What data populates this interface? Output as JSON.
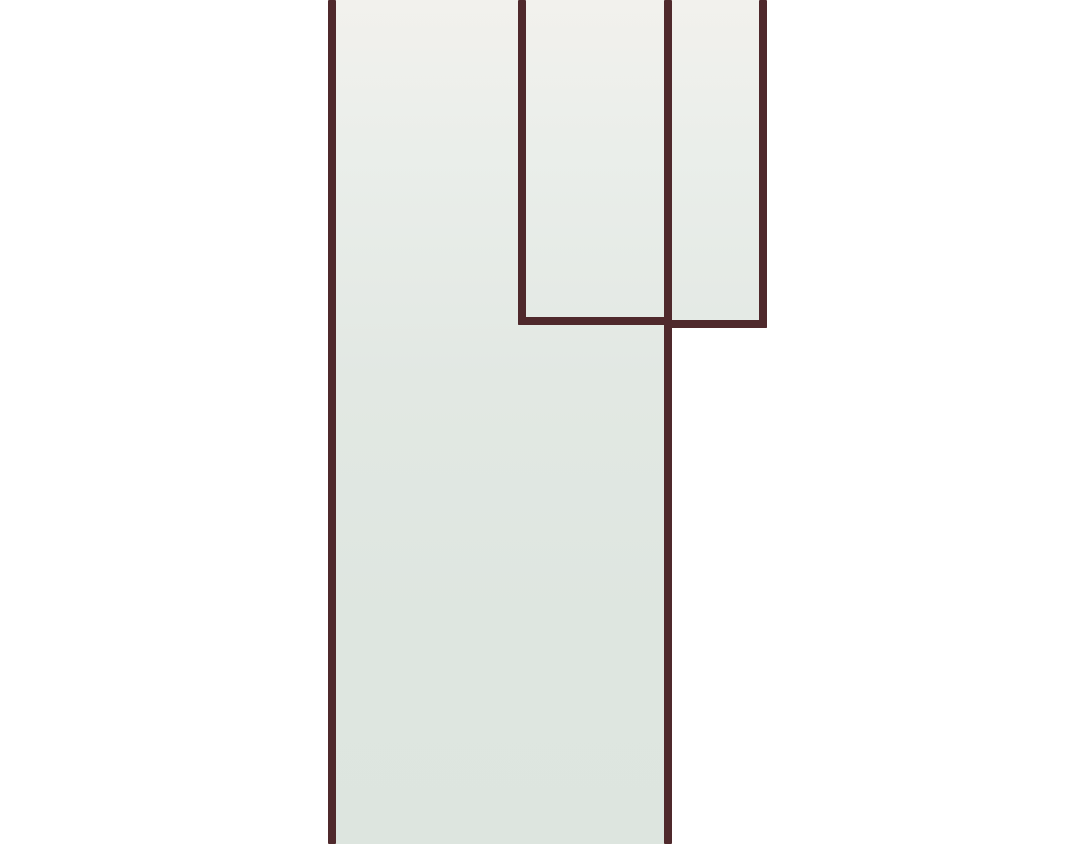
{
  "canvas": {
    "width": 1080,
    "height": 844,
    "background_color": "#ffffff"
  },
  "style": {
    "border_color": "#4f292c",
    "border_thickness": 8,
    "fill_gradient_height": 844,
    "fill_gradient_stops": [
      {
        "pos": 0,
        "color": "#f2f1ed"
      },
      {
        "pos": 18,
        "color": "#eaeeea"
      },
      {
        "pos": 45,
        "color": "#e2e8e3"
      },
      {
        "pos": 75,
        "color": "#dee6e0"
      },
      {
        "pos": 100,
        "color": "#dde5df"
      }
    ]
  },
  "shapes": {
    "fills": [
      {
        "name": "main-panel-fill",
        "x": 332,
        "y": 0,
        "w": 336,
        "h": 844
      },
      {
        "name": "top-right-panel-fill",
        "x": 668,
        "y": 0,
        "w": 95,
        "h": 324
      }
    ],
    "lines": [
      {
        "name": "main-panel-left-border",
        "x": 328,
        "y": 0,
        "w": 8,
        "h": 844
      },
      {
        "name": "inner-panel-left-border",
        "x": 518,
        "y": 0,
        "w": 8,
        "h": 325
      },
      {
        "name": "main-panel-right-border",
        "x": 664,
        "y": 0,
        "w": 8,
        "h": 844
      },
      {
        "name": "top-right-panel-right-border",
        "x": 759,
        "y": 0,
        "w": 8,
        "h": 328
      },
      {
        "name": "inner-panel-bottom-border",
        "x": 518,
        "y": 317,
        "w": 154,
        "h": 8
      },
      {
        "name": "top-right-panel-bottom-border",
        "x": 664,
        "y": 320,
        "w": 103,
        "h": 8
      }
    ]
  }
}
